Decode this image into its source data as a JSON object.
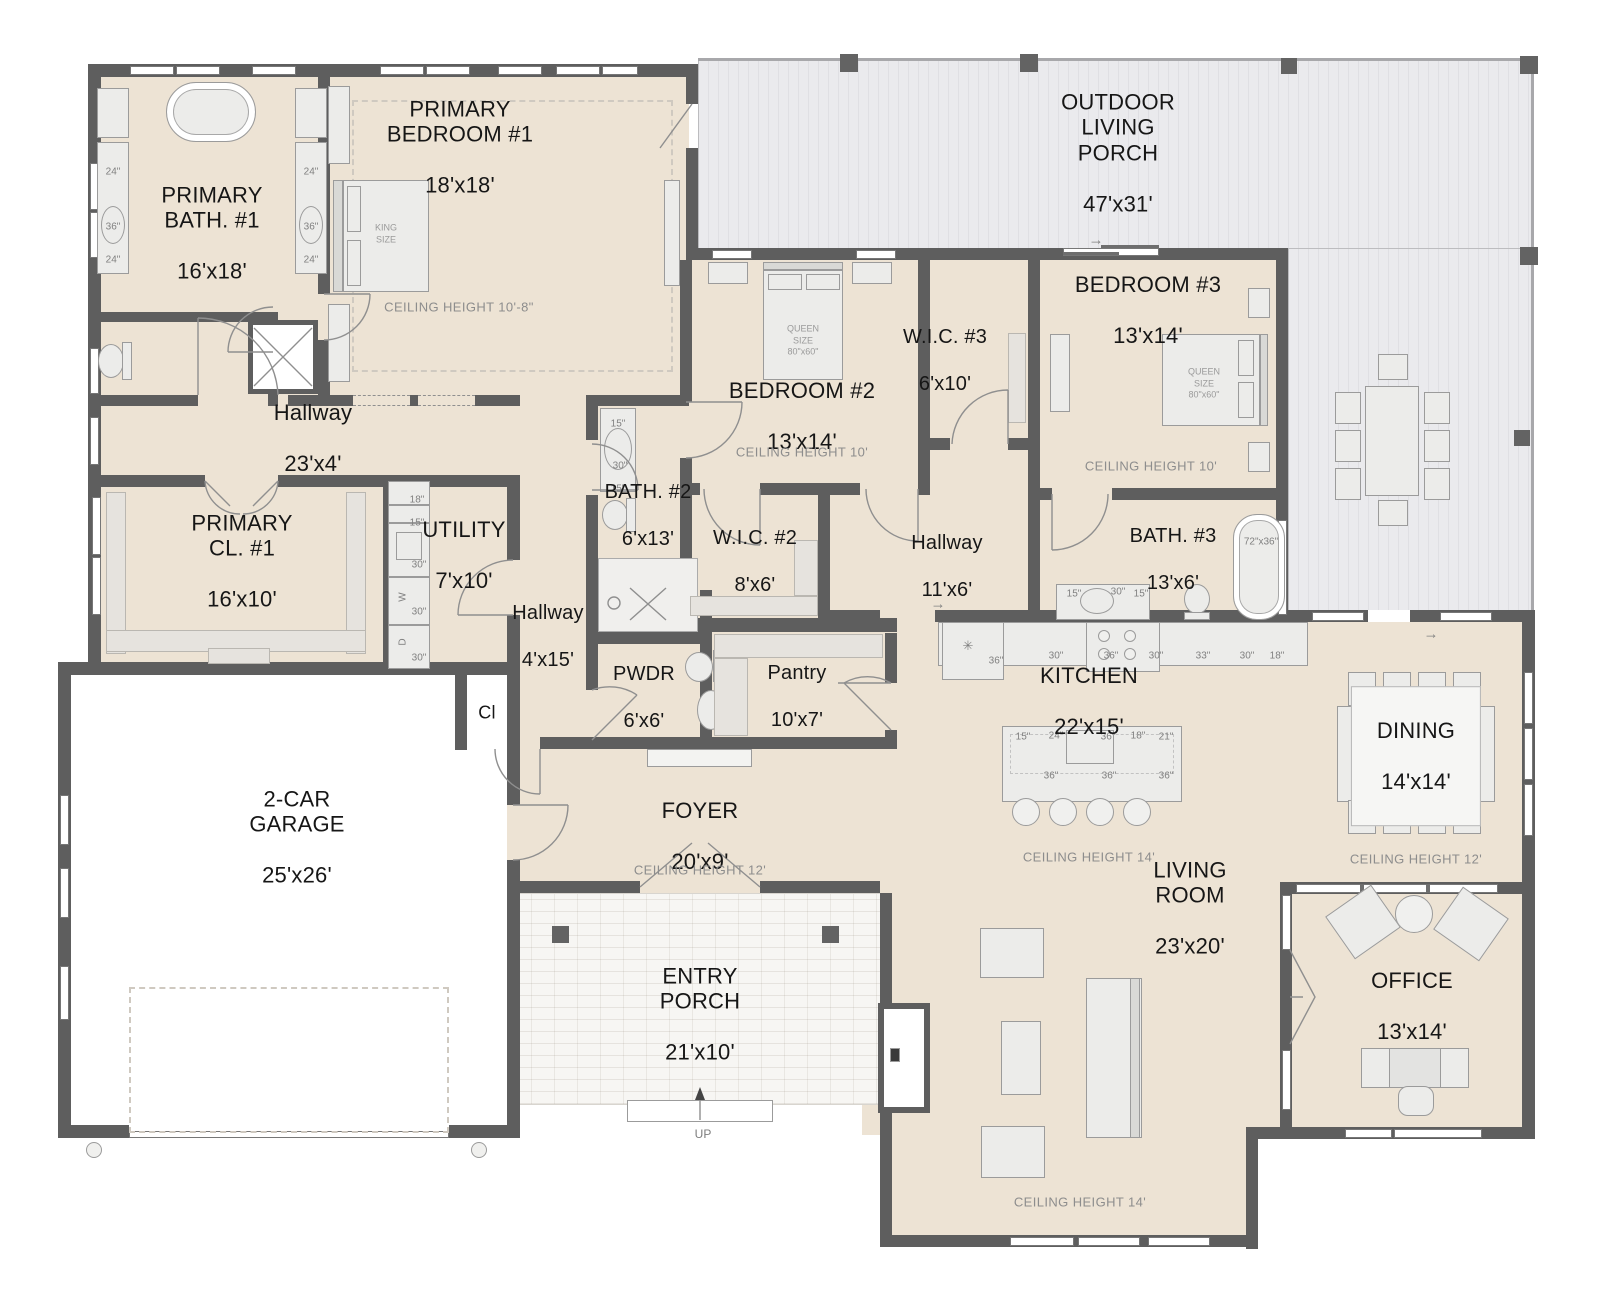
{
  "colors": {
    "wall": "#5e5e5e",
    "floor": "#ede3d4",
    "porch": "#e9e9ec",
    "text_dark": "#161616",
    "text_muted": "#8d8d8d"
  },
  "rooms": {
    "primary_bath": {
      "name": "PRIMARY\nBATH. #1",
      "dims": "16'x18'"
    },
    "primary_bedroom": {
      "name": "PRIMARY\nBEDROOM #1",
      "dims": "18'x18'"
    },
    "outdoor_porch": {
      "name": "OUTDOOR\nLIVING\nPORCH",
      "dims": "47'x31'"
    },
    "bedroom2": {
      "name": "BEDROOM #2",
      "dims": "13'x14'"
    },
    "bedroom3": {
      "name": "BEDROOM #3",
      "dims": "13'x14'"
    },
    "wic3": {
      "name": "W.I.C. #3",
      "dims": "6'x10'"
    },
    "wic2": {
      "name": "W.I.C. #2",
      "dims": "8'x6'"
    },
    "bath2": {
      "name": "BATH. #2",
      "dims": "6'x13'"
    },
    "bath3": {
      "name": "BATH. #3",
      "dims": "13'x6'"
    },
    "hallway_23": {
      "name": "Hallway",
      "dims": "23'x4'"
    },
    "hallway_4": {
      "name": "Hallway",
      "dims": "4'x15'"
    },
    "hallway_11": {
      "name": "Hallway",
      "dims": "11'x6'"
    },
    "utility": {
      "name": "UTILITY",
      "dims": "7'x10'"
    },
    "primary_closet": {
      "name": "PRIMARY\nCL. #1",
      "dims": "16'x10'"
    },
    "pwdr": {
      "name": "PWDR",
      "dims": "6'x6'"
    },
    "pantry": {
      "name": "Pantry",
      "dims": "10'x7'"
    },
    "kitchen": {
      "name": "KITCHEN",
      "dims": "22'x15'"
    },
    "dining": {
      "name": "DINING",
      "dims": "14'x14'"
    },
    "foyer": {
      "name": "FOYER",
      "dims": "20'x9'"
    },
    "garage": {
      "name": "2-CAR\nGARAGE",
      "dims": "25'x26'"
    },
    "entry_porch": {
      "name": "ENTRY\nPORCH",
      "dims": "21'x10'"
    },
    "living": {
      "name": "LIVING\nROOM",
      "dims": "23'x20'"
    },
    "office": {
      "name": "OFFICE",
      "dims": "13'x14'"
    },
    "closet_cl": {
      "name": "Cl"
    }
  },
  "ceilings": {
    "primary_bedroom": "CEILING HEIGHT 10'-8\"",
    "bedroom2": "CEILING HEIGHT 10'",
    "bedroom3": "CEILING HEIGHT 10'",
    "kitchen": "CEILING HEIGHT 14'",
    "dining": "CEILING HEIGHT 12'",
    "foyer": "CEILING HEIGHT 12'",
    "living": "CEILING HEIGHT 14'"
  },
  "fixtures": {
    "king_bed": "KING SIZE",
    "queen_bed": "QUEEN SIZE 80\"x60\"",
    "up": "UP"
  },
  "annotations": [
    {
      "t": "24\"",
      "x": 113,
      "y": 172
    },
    {
      "t": "36\"",
      "x": 113,
      "y": 227
    },
    {
      "t": "24\"",
      "x": 113,
      "y": 260
    },
    {
      "t": "24\"",
      "x": 311,
      "y": 172
    },
    {
      "t": "36\"",
      "x": 311,
      "y": 227
    },
    {
      "t": "24\"",
      "x": 311,
      "y": 260
    },
    {
      "t": "15\"",
      "x": 618,
      "y": 424
    },
    {
      "t": "30\"",
      "x": 620,
      "y": 466
    },
    {
      "t": "15\"",
      "x": 618,
      "y": 489
    },
    {
      "t": "18\"",
      "x": 417,
      "y": 500
    },
    {
      "t": "15\"",
      "x": 417,
      "y": 523
    },
    {
      "t": "30\"",
      "x": 419,
      "y": 565
    },
    {
      "t": "W",
      "x": 403,
      "y": 597,
      "r": -90
    },
    {
      "t": "30\"",
      "x": 419,
      "y": 612
    },
    {
      "t": "D",
      "x": 403,
      "y": 642,
      "r": -90
    },
    {
      "t": "30\"",
      "x": 419,
      "y": 658
    },
    {
      "t": "15\"",
      "x": 1074,
      "y": 594
    },
    {
      "t": "30\"",
      "x": 1118,
      "y": 592
    },
    {
      "t": "15\"",
      "x": 1141,
      "y": 594
    },
    {
      "t": "72\"x36\"",
      "x": 1261,
      "y": 542
    },
    {
      "t": "36\"",
      "x": 996,
      "y": 661
    },
    {
      "t": "30\"",
      "x": 1056,
      "y": 656
    },
    {
      "t": "36\"",
      "x": 1111,
      "y": 656
    },
    {
      "t": "30\"",
      "x": 1156,
      "y": 656
    },
    {
      "t": "33\"",
      "x": 1203,
      "y": 656
    },
    {
      "t": "30\"",
      "x": 1247,
      "y": 656
    },
    {
      "t": "18\"",
      "x": 1277,
      "y": 656
    },
    {
      "t": "15\"",
      "x": 1023,
      "y": 737
    },
    {
      "t": "24\"",
      "x": 1056,
      "y": 736
    },
    {
      "t": "36\"",
      "x": 1108,
      "y": 737
    },
    {
      "t": "18\"",
      "x": 1138,
      "y": 736
    },
    {
      "t": "21\"",
      "x": 1166,
      "y": 737
    },
    {
      "t": "36\"",
      "x": 1051,
      "y": 776
    },
    {
      "t": "36\"",
      "x": 1109,
      "y": 776
    },
    {
      "t": "36\"",
      "x": 1166,
      "y": 776
    },
    {
      "t": "✳",
      "x": 968,
      "y": 646,
      "s": 13
    },
    {
      "t": "→",
      "x": 938,
      "y": 604,
      "s": 15
    },
    {
      "t": "→",
      "x": 1431,
      "y": 634,
      "s": 15
    },
    {
      "t": "→",
      "x": 1096,
      "y": 240,
      "s": 15
    }
  ]
}
